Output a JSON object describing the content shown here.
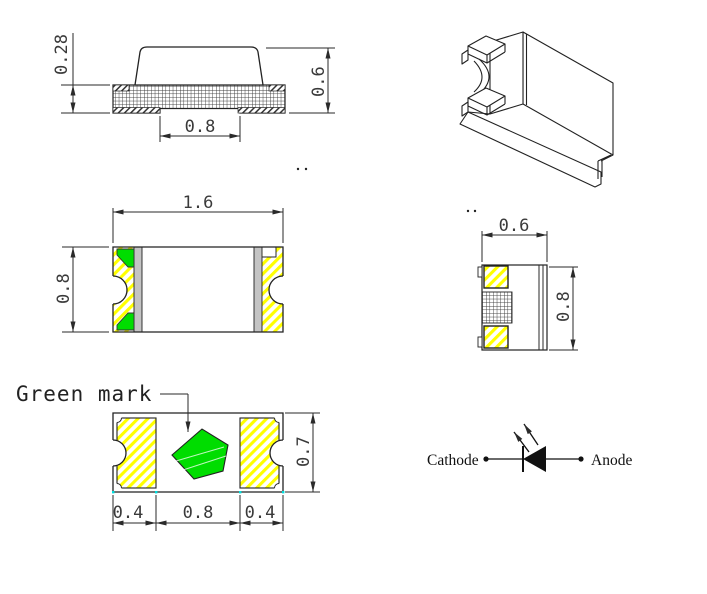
{
  "drawing_title": "SMD chip LED package outline drawing",
  "colors": {
    "background": "#ffffff",
    "line": "#222222",
    "dim_text": "#3a3a3a",
    "green_mark": "#00dd00",
    "hatch_yellow": "#ffff00",
    "terminal_gray": "#c4c4c4",
    "tick_cyan": "#00e0e0"
  },
  "views": {
    "side_view": {
      "dim_substrate_thickness": "0.28",
      "dim_total_height": "0.6",
      "dim_bottom_pad_width": "0.8"
    },
    "top_view": {
      "dim_length": "1.6",
      "dim_width": "0.8"
    },
    "end_view": {
      "dim_width": "0.6",
      "dim_height": "0.8"
    },
    "bottom_view": {
      "green_mark_label": "Green mark",
      "dim_left_pad": "0.4",
      "dim_center_gap": "0.8",
      "dim_right_pad": "0.4",
      "dim_body_width": "0.7"
    },
    "polarity_symbol": {
      "cathode_label": "Cathode",
      "anode_label": "Anode"
    }
  }
}
